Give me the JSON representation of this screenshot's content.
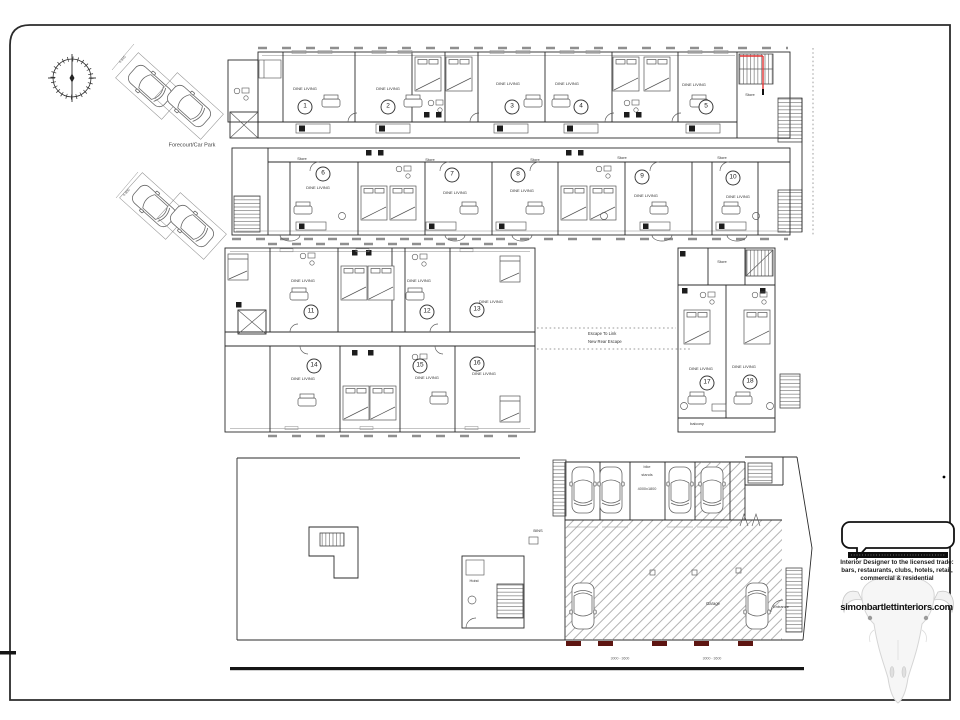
{
  "document": {
    "type": "architectural-floor-plan-sheet"
  },
  "units": [
    "1",
    "2",
    "3",
    "4",
    "5",
    "6",
    "7",
    "8",
    "9",
    "10",
    "11",
    "12",
    "13",
    "14",
    "15",
    "16",
    "17",
    "18"
  ],
  "labels": {
    "dine_living": "DINE LIVING",
    "store": "Store",
    "forecourt": "Forecourt/Car Park",
    "escape_line1": "Escape To Link",
    "escape_line2": "New Rear Escape",
    "balcony": "balcony",
    "bins": "BINS",
    "garage": "Garage",
    "entrance": "Entrance",
    "hoist": "Hoist",
    "bike_line1": "bike",
    "bike_line2": "stands",
    "bike_dims": "4000x1800",
    "bay_dim_a": "4.845",
    "bay_dim_b": "4.800",
    "door_dims": "3000 - 3600"
  },
  "logo": {
    "line1": "Interior Designer to the licensed trade:",
    "line2": "bars, restaurants, clubs, hotels, retail,",
    "line3": "commercial & residential",
    "website": "simonbartlettinteriors.com"
  },
  "colors": {
    "escape_red": "#e03434",
    "door_marker": "#5d1511",
    "hatch": "#808080",
    "line": "#2b2b2b"
  }
}
